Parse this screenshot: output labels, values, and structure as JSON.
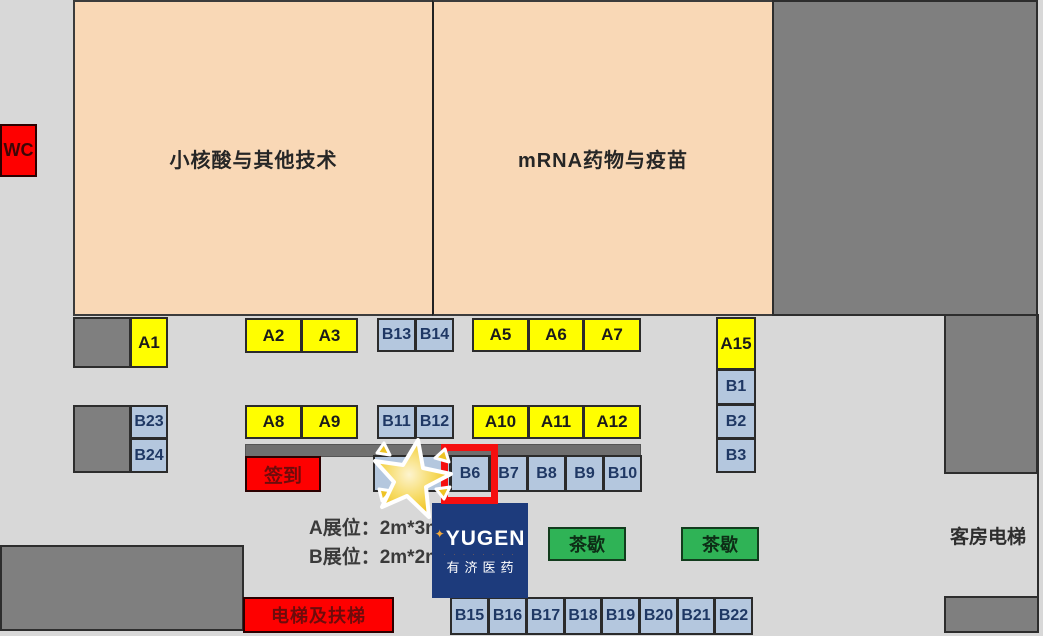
{
  "zones": {
    "left_hall": "小核酸与其他技术",
    "right_hall": "mRNA药物与疫苗"
  },
  "labels": {
    "wc": "WC",
    "sign_in": "签到",
    "tea_break_1": "茶歇",
    "tea_break_2": "茶歇",
    "elevator_escalator": "电梯及扶梯",
    "guest_elevator": "客房电梯"
  },
  "legend": {
    "booth_a": "A展位：2m*3m",
    "booth_b": "B展位：2m*2m"
  },
  "booths": {
    "a1": "A1",
    "a2": "A2",
    "a3": "A3",
    "a5": "A5",
    "a6": "A6",
    "a7": "A7",
    "a8": "A8",
    "a9": "A9",
    "a10": "A10",
    "a11": "A11",
    "a12": "A12",
    "a15": "A15",
    "b1": "B1",
    "b2": "B2",
    "b3": "B3",
    "b6": "B6",
    "b7": "B7",
    "b8": "B8",
    "b9": "B9",
    "b10": "B10",
    "b11": "B11",
    "b12": "B12",
    "b13": "B13",
    "b14": "B14",
    "b15": "B15",
    "b16": "B16",
    "b17": "B17",
    "b18": "B18",
    "b19": "B19",
    "b20": "B20",
    "b21": "B21",
    "b22": "B22",
    "b23": "B23",
    "b24": "B24"
  },
  "highlight": {
    "booth": "B6"
  },
  "logo": {
    "brand": "YUGEN",
    "tagline_dots": "· · · · · · · ·",
    "brand_cn": "有济医药"
  },
  "icons": {
    "sparkle": "✦",
    "star_marker": "star-burst"
  },
  "colors": {
    "background": "#d8d8d8",
    "zone_peach": "#f9d8b6",
    "booth_yellow": "#fffe00",
    "booth_blue": "#b4c7de",
    "accent_red": "#fe0000",
    "tea_green": "#2fb356",
    "logo_navy": "#1d3b7c",
    "block_gray": "#7f7f7f",
    "star_gold": "#f2c01d"
  }
}
